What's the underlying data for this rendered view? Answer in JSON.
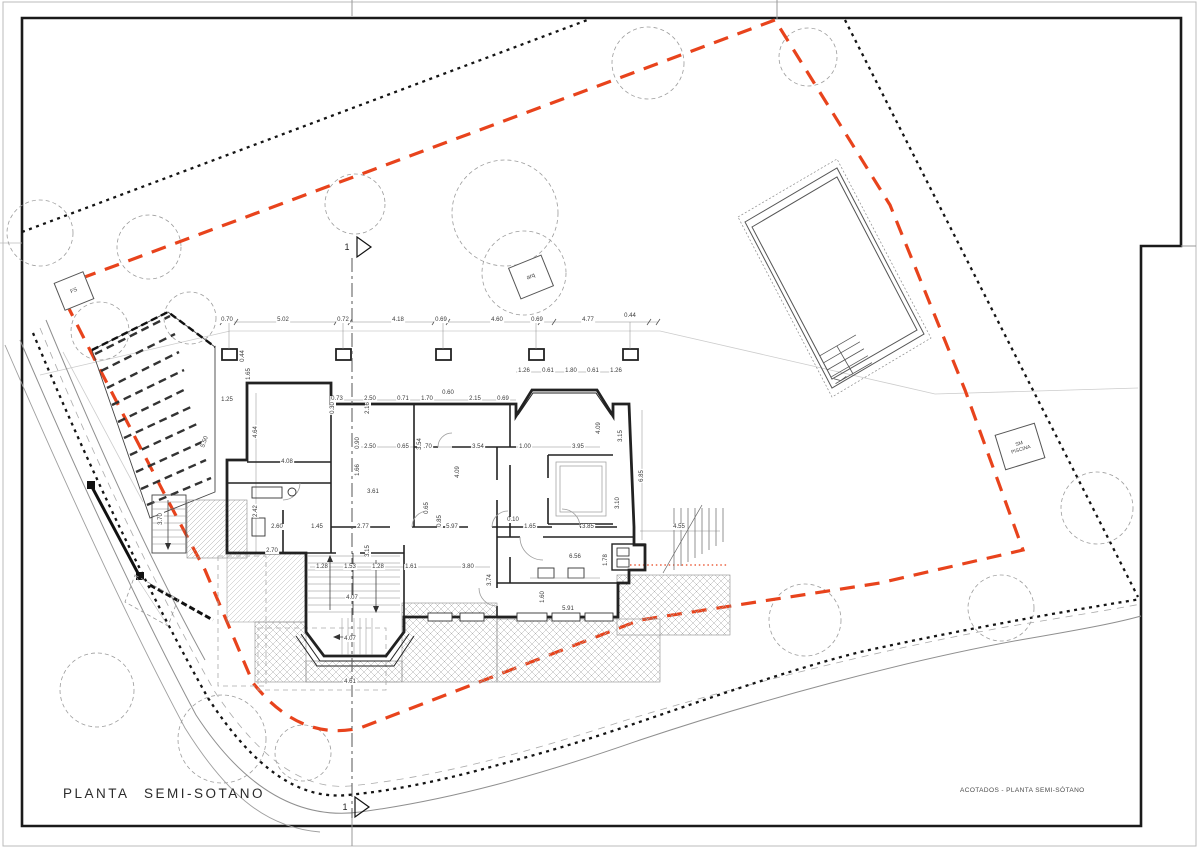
{
  "sheet": {
    "title": "PLANTA SEMI-SOTANO",
    "caption": "ACOTADOS - PLANTA SEMI-SÓTANO"
  },
  "markers": {
    "section_number": "1"
  },
  "site_labels": {
    "fs": "FS",
    "arq": "arq",
    "pool_line1": "SM",
    "pool_line2": "PISCINA"
  },
  "colors": {
    "setback_line": "#e8431c",
    "boundary_line": "#141414",
    "wall": "#222222",
    "road_edge": "#8f8f8f",
    "tree_outline": "#9c9c9c",
    "dimension_text": "#3a3a3a"
  },
  "drawing": {
    "dimensions": [
      {
        "v": "0.70",
        "x": 227,
        "y": 320,
        "r": 0
      },
      {
        "v": "5.02",
        "x": 283,
        "y": 320,
        "r": 0
      },
      {
        "v": "0.72",
        "x": 343,
        "y": 320,
        "r": 0
      },
      {
        "v": "4.18",
        "x": 398,
        "y": 320,
        "r": 0
      },
      {
        "v": "0.69",
        "x": 441,
        "y": 320,
        "r": 0
      },
      {
        "v": "4.60",
        "x": 497,
        "y": 320,
        "r": 0
      },
      {
        "v": "0.69",
        "x": 537,
        "y": 320,
        "r": 0
      },
      {
        "v": "4.77",
        "x": 588,
        "y": 320,
        "r": 0
      },
      {
        "v": "0.44",
        "x": 630,
        "y": 316,
        "r": 0
      },
      {
        "v": "0.44",
        "x": 243,
        "y": 356,
        "r": -90
      },
      {
        "v": "1.65",
        "x": 249,
        "y": 374,
        "r": -90
      },
      {
        "v": "1.25",
        "x": 227,
        "y": 400,
        "r": 0
      },
      {
        "v": "4.64",
        "x": 256,
        "y": 432,
        "r": -90
      },
      {
        "v": "2.42",
        "x": 256,
        "y": 511,
        "r": -90
      },
      {
        "v": "5.50",
        "x": 205,
        "y": 442,
        "r": -70
      },
      {
        "v": "3.70",
        "x": 161,
        "y": 519,
        "r": -90
      },
      {
        "v": "1.26",
        "x": 524,
        "y": 371,
        "r": 0
      },
      {
        "v": "0.61",
        "x": 548,
        "y": 371,
        "r": 0
      },
      {
        "v": "1.80",
        "x": 571,
        "y": 371,
        "r": 0
      },
      {
        "v": "0.61",
        "x": 593,
        "y": 371,
        "r": 0
      },
      {
        "v": "1.26",
        "x": 616,
        "y": 371,
        "r": 0
      },
      {
        "v": "0.73",
        "x": 337,
        "y": 399,
        "r": 0
      },
      {
        "v": "2.50",
        "x": 370,
        "y": 399,
        "r": 0
      },
      {
        "v": "0.71",
        "x": 403,
        "y": 399,
        "r": 0
      },
      {
        "v": "1.70",
        "x": 427,
        "y": 399,
        "r": 0
      },
      {
        "v": "0.60",
        "x": 448,
        "y": 393,
        "r": 0
      },
      {
        "v": "2.15",
        "x": 475,
        "y": 399,
        "r": 0
      },
      {
        "v": "0.69",
        "x": 503,
        "y": 399,
        "r": 0
      },
      {
        "v": "0.30",
        "x": 333,
        "y": 408,
        "r": -90
      },
      {
        "v": "2.16",
        "x": 368,
        "y": 408,
        "r": -90
      },
      {
        "v": "2.50",
        "x": 370,
        "y": 447,
        "r": 0
      },
      {
        "v": "0.65",
        "x": 403,
        "y": 447,
        "r": 0
      },
      {
        "v": "1.70",
        "x": 426,
        "y": 447,
        "r": 0
      },
      {
        "v": "3.54",
        "x": 478,
        "y": 447,
        "r": 0
      },
      {
        "v": "1.00",
        "x": 525,
        "y": 447,
        "r": 0
      },
      {
        "v": "3.95",
        "x": 578,
        "y": 447,
        "r": 0
      },
      {
        "v": "4.08",
        "x": 287,
        "y": 462,
        "r": 0
      },
      {
        "v": "0.90",
        "x": 358,
        "y": 443,
        "r": -90
      },
      {
        "v": "1.66",
        "x": 358,
        "y": 470,
        "r": -90
      },
      {
        "v": "3.54",
        "x": 420,
        "y": 444,
        "r": -90
      },
      {
        "v": "4.09",
        "x": 458,
        "y": 472,
        "r": -90
      },
      {
        "v": "4.09",
        "x": 599,
        "y": 428,
        "r": -90
      },
      {
        "v": "3.15",
        "x": 621,
        "y": 436,
        "r": -90
      },
      {
        "v": "3.61",
        "x": 373,
        "y": 492,
        "r": 0
      },
      {
        "v": "0.65",
        "x": 427,
        "y": 508,
        "r": -90
      },
      {
        "v": "0.85",
        "x": 440,
        "y": 521,
        "r": -90
      },
      {
        "v": "2.60",
        "x": 277,
        "y": 527,
        "r": 0
      },
      {
        "v": "1.45",
        "x": 317,
        "y": 527,
        "r": 0
      },
      {
        "v": "2.77",
        "x": 363,
        "y": 527,
        "r": 0
      },
      {
        "v": "5.97",
        "x": 452,
        "y": 527,
        "r": 0
      },
      {
        "v": "0.10",
        "x": 513,
        "y": 520,
        "r": 0
      },
      {
        "v": "1.65",
        "x": 530,
        "y": 527,
        "r": 0
      },
      {
        "v": "3.85",
        "x": 588,
        "y": 527,
        "r": 0
      },
      {
        "v": "4.55",
        "x": 679,
        "y": 527,
        "r": 0
      },
      {
        "v": "3.10",
        "x": 618,
        "y": 503,
        "r": -90
      },
      {
        "v": "6.85",
        "x": 642,
        "y": 476,
        "r": -90
      },
      {
        "v": "2.70",
        "x": 272,
        "y": 551,
        "r": 0
      },
      {
        "v": "3.15",
        "x": 368,
        "y": 551,
        "r": -90
      },
      {
        "v": "1.28",
        "x": 322,
        "y": 567,
        "r": 0
      },
      {
        "v": "1.53",
        "x": 350,
        "y": 567,
        "r": 0
      },
      {
        "v": "1.28",
        "x": 378,
        "y": 567,
        "r": 0
      },
      {
        "v": "1.61",
        "x": 411,
        "y": 567,
        "r": 0
      },
      {
        "v": "3.80",
        "x": 468,
        "y": 567,
        "r": 0
      },
      {
        "v": "3.74",
        "x": 490,
        "y": 580,
        "r": -90
      },
      {
        "v": "6.56",
        "x": 575,
        "y": 557,
        "r": 0
      },
      {
        "v": "1.78",
        "x": 606,
        "y": 560,
        "r": -90
      },
      {
        "v": "4.07",
        "x": 352,
        "y": 598,
        "r": 0
      },
      {
        "v": "4.07",
        "x": 350,
        "y": 639,
        "r": 0
      },
      {
        "v": "1.60",
        "x": 543,
        "y": 597,
        "r": -90
      },
      {
        "v": "5.91",
        "x": 568,
        "y": 609,
        "r": 0
      },
      {
        "v": "4.61",
        "x": 350,
        "y": 682,
        "r": 0
      }
    ]
  }
}
